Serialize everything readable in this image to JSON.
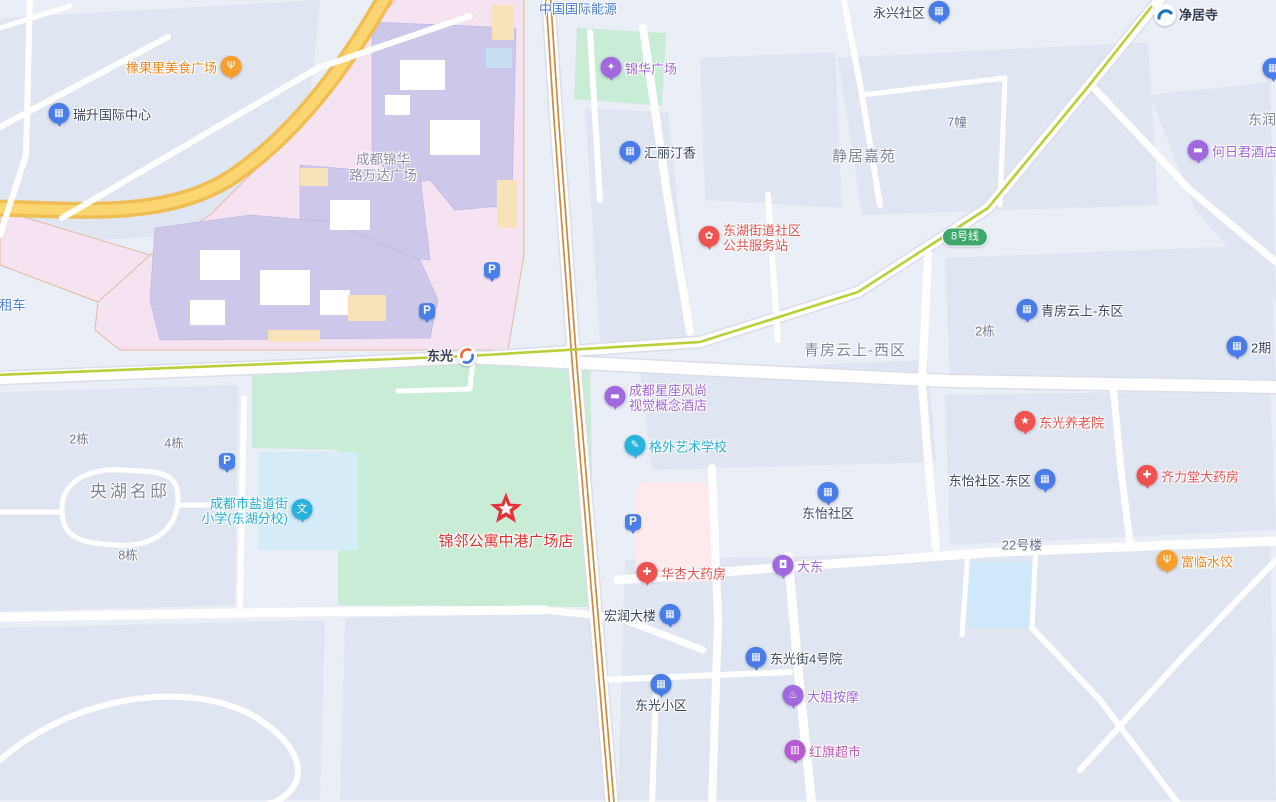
{
  "colors": {
    "bg": "#eaeef6",
    "block": "#e0e6f1",
    "road": "#ffffff",
    "road_casing": "#d9deea",
    "highway_outer": "#f0bd55",
    "highway_inner": "#fbd570",
    "mall_zone": "#f6e3f2",
    "mall_zone_border": "#e3b9a0",
    "mall_building": "#cdc7ea",
    "mall_tan": "#f8e2ba",
    "mall_blue": "#c6dff2",
    "park": "#c9ecd6",
    "school_ground": "#d5ebf8",
    "pool": "#cfe9fa",
    "hospital": "#fdeaec",
    "metro_line": "#b9cf3a",
    "rail_orange": "#cf8a3e",
    "line8_badge": "#3ea76a",
    "pin_blue": "#4a7ce8",
    "pin_purple": "#a268dd",
    "pin_red": "#ee5350",
    "pin_orange": "#f5a02d",
    "pin_cyan": "#29b2dc",
    "pin_magenta": "#b75ad2",
    "star_red": "#e53238",
    "text_dark": "#3a4660",
    "text_gray": "#7e8798",
    "text_gray_small": "#6e7890",
    "text_red": "#e8504d",
    "text_orange": "#f0871d",
    "text_purple": "#a266d8",
    "text_cyan": "#21b0d8",
    "text_blue": "#4a7dd4",
    "text_magenta": "#c45ab8",
    "text_wanda": "#8f8ba6",
    "text_star": "#e12f2f"
  },
  "map": {
    "pois": [
      {
        "id": "poi-xiangguoli-food-plaza",
        "type": "pin",
        "x": 231,
        "y": 68,
        "color": "#f5a02d",
        "glyph": "Ψ",
        "icon": "food-pin-icon",
        "label": {
          "text": "橡果里美食广场",
          "side": "left",
          "color": "#f0871d"
        }
      },
      {
        "id": "poi-ruisheng-intl-center",
        "type": "pin",
        "x": 59,
        "y": 115,
        "color": "#4a7ce8",
        "glyph": "▦",
        "icon": "building-pin-icon",
        "label": {
          "text": "瑞升国际中心",
          "side": "right",
          "color": "#3a4660"
        }
      },
      {
        "id": "label-china-intl-energy",
        "type": "text",
        "x": 578,
        "y": 9,
        "interactable": false,
        "label": {
          "text": "中国国际能源",
          "side": "center",
          "color": "#4a7dd4"
        }
      },
      {
        "id": "poi-jinhua-plaza",
        "type": "pin",
        "x": 611,
        "y": 69,
        "color": "#a268dd",
        "glyph": "✦",
        "icon": "plaza-pin-icon",
        "label": {
          "text": "锦华广场",
          "side": "right",
          "color": "#a266d8"
        }
      },
      {
        "id": "poi-yongxing-community",
        "type": "pin",
        "x": 939,
        "y": 13,
        "color": "#4a7ce8",
        "glyph": "▦",
        "icon": "building-pin-icon",
        "label": {
          "text": "永兴社区",
          "side": "left",
          "color": "#3a4660"
        }
      },
      {
        "id": "poi-jingjusi-metro-station",
        "type": "metro",
        "x": 1165,
        "y": 15,
        "icon": "metro-station-icon",
        "label": {
          "text": "净居寺",
          "side": "right",
          "color": "#333c52",
          "bold": true
        }
      },
      {
        "id": "poi-partial-pin-right-edge",
        "type": "pin",
        "x": 1273,
        "y": 70,
        "color": "#4a7ce8",
        "glyph": "▦",
        "icon": "building-pin-icon"
      },
      {
        "id": "label-dongrun",
        "type": "text",
        "x": 1262,
        "y": 120,
        "interactable": false,
        "label": {
          "text": "东润",
          "side": "center",
          "color": "#7e8798",
          "size": 14
        }
      },
      {
        "id": "poi-heriju-hotel",
        "type": "pin",
        "x": 1198,
        "y": 152,
        "color": "#a268dd",
        "glyph": "▬",
        "icon": "hotel-bed-pin-icon",
        "label": {
          "text": "何日君酒店",
          "side": "right",
          "color": "#a266d8"
        }
      },
      {
        "id": "poi-huili-tingxiang",
        "type": "pin",
        "x": 630,
        "y": 153,
        "color": "#4a7ce8",
        "glyph": "▦",
        "icon": "building-pin-icon",
        "label": {
          "text": "汇丽汀香",
          "side": "right",
          "color": "#3a4660"
        }
      },
      {
        "id": "label-jingju-jiayuan",
        "type": "text",
        "x": 864,
        "y": 157,
        "interactable": false,
        "label": {
          "text": "静居嘉苑",
          "side": "center",
          "color": "#7e8798",
          "size": 15,
          "ls": 1
        }
      },
      {
        "id": "label-7zhuang",
        "type": "text",
        "x": 957,
        "y": 123,
        "interactable": false,
        "label": {
          "text": "7幢",
          "side": "center",
          "color": "#6e7890",
          "size": 12.5
        }
      },
      {
        "id": "label-wanda-plaza",
        "type": "text",
        "x": 383,
        "y": 168,
        "interactable": false,
        "label": {
          "lines": [
            "成都锦华",
            "路万达广场"
          ],
          "side": "center",
          "color": "#8f8ba6",
          "size": 13.5
        }
      },
      {
        "id": "poi-donghu-street-community-service",
        "type": "pin",
        "x": 709,
        "y": 238,
        "color": "#ee5350",
        "glyph": "✿",
        "icon": "flower-pin-icon",
        "label": {
          "lines": [
            "东湖街道社区",
            "公共服务站"
          ],
          "side": "right",
          "color": "#e8504d"
        }
      },
      {
        "id": "badge-line8",
        "type": "badge",
        "x": 965,
        "y": 237,
        "label": {
          "text": "8号线"
        }
      },
      {
        "id": "poi-qingfang-yunshang-east",
        "type": "pin",
        "x": 1027,
        "y": 311,
        "color": "#4a7ce8",
        "glyph": "▦",
        "icon": "building-pin-icon",
        "label": {
          "text": "青房云上-东区",
          "side": "right",
          "color": "#3a4660"
        }
      },
      {
        "id": "label-2dong-right",
        "type": "text",
        "x": 985,
        "y": 332,
        "interactable": false,
        "label": {
          "text": "2栋",
          "side": "center",
          "color": "#6e7890",
          "size": 12.5
        }
      },
      {
        "id": "poi-2qi",
        "type": "pin",
        "x": 1237,
        "y": 348,
        "color": "#4a7ce8",
        "glyph": "▦",
        "icon": "building-pin-icon",
        "label": {
          "text": "2期",
          "side": "right",
          "color": "#3a4660"
        }
      },
      {
        "id": "label-qingfang-yunshang-west",
        "type": "text",
        "x": 855,
        "y": 351,
        "interactable": false,
        "label": {
          "text": "青房云上-西区",
          "side": "center",
          "color": "#7e8798",
          "size": 15,
          "ls": 1
        }
      },
      {
        "id": "poi-dongguang-station",
        "type": "loop",
        "x": 467,
        "y": 356,
        "icon": "dongguang-loop-station-icon",
        "label": {
          "text": "东光",
          "side": "left",
          "color": "#333c52",
          "bold": true
        }
      },
      {
        "id": "label-zuche",
        "type": "text",
        "x": 6,
        "y": 305,
        "interactable": false,
        "label": {
          "text": "宇租车",
          "side": "center",
          "color": "#4a7dd4"
        }
      },
      {
        "id": "poi-xingzuo-fashion-hotel",
        "type": "pin",
        "x": 615,
        "y": 398,
        "color": "#a268dd",
        "glyph": "▬",
        "icon": "hotel-bed-pin-icon",
        "label": {
          "lines": [
            "成都星座风尚",
            "视觉概念酒店"
          ],
          "side": "right",
          "color": "#a266d8"
        }
      },
      {
        "id": "poi-gewai-art-school",
        "type": "pin",
        "x": 635,
        "y": 447,
        "color": "#29b2dc",
        "glyph": "✎",
        "icon": "school-pencil-pin-icon",
        "label": {
          "text": "格外艺术学校",
          "side": "right",
          "color": "#21b0d8"
        }
      },
      {
        "id": "poi-dongguang-nursing-home",
        "type": "pin",
        "x": 1025,
        "y": 423,
        "color": "#ee5350",
        "glyph": "★",
        "icon": "star-pin-icon",
        "label": {
          "text": "东光养老院",
          "side": "right",
          "color": "#e8504d"
        }
      },
      {
        "id": "poi-qilitang-pharmacy",
        "type": "pin",
        "x": 1147,
        "y": 477,
        "color": "#ee5350",
        "glyph": "✚",
        "icon": "pharmacy-pin-icon",
        "label": {
          "text": "齐力堂大药房",
          "side": "right",
          "color": "#e8504d"
        }
      },
      {
        "id": "poi-dongyi-community-east",
        "type": "pin",
        "x": 1045,
        "y": 481,
        "color": "#4a7ce8",
        "glyph": "▦",
        "icon": "building-pin-icon",
        "label": {
          "text": "东怡社区-东区",
          "side": "left",
          "color": "#3a4660"
        }
      },
      {
        "id": "poi-dongyi-community",
        "type": "pin",
        "x": 828,
        "y": 494,
        "color": "#4a7ce8",
        "glyph": "▦",
        "icon": "building-pin-icon",
        "label": {
          "text": "东怡社区",
          "side": "below",
          "color": "#3a4660"
        }
      },
      {
        "id": "label-2dong-left",
        "type": "text",
        "x": 79,
        "y": 440,
        "interactable": false,
        "label": {
          "text": "2栋",
          "side": "center",
          "color": "#6e7890",
          "size": 12.5
        }
      },
      {
        "id": "label-4dong",
        "type": "text",
        "x": 174,
        "y": 444,
        "interactable": false,
        "label": {
          "text": "4栋",
          "side": "center",
          "color": "#6e7890",
          "size": 12.5
        }
      },
      {
        "id": "label-8dong",
        "type": "text",
        "x": 128,
        "y": 556,
        "interactable": false,
        "label": {
          "text": "8栋",
          "side": "center",
          "color": "#6e7890",
          "size": 12.5
        }
      },
      {
        "id": "label-yanghu-mingdi",
        "type": "text",
        "x": 130,
        "y": 492,
        "interactable": false,
        "label": {
          "text": "央湖名邸",
          "side": "center",
          "color": "#7e8798",
          "size": 17,
          "ls": 3
        }
      },
      {
        "id": "poi-yandaojie-primary-school",
        "type": "pin",
        "x": 302,
        "y": 511,
        "color": "#29b2dc",
        "glyph": "文",
        "icon": "school-wen-pin-icon",
        "label": {
          "lines": [
            "成都市盐道街",
            "小学(东湖分校)"
          ],
          "side": "left",
          "color": "#21b0d8"
        }
      },
      {
        "id": "poi-jinlin-apartment-star",
        "type": "star",
        "x": 506,
        "y": 513,
        "icon": "red-star-marker-icon",
        "label": {
          "text": "锦邻公寓中港广场店",
          "side": "below",
          "color": "#e12f2f",
          "size": 15,
          "below_off": 20
        }
      },
      {
        "id": "label-22haolou",
        "type": "text",
        "x": 1022,
        "y": 545,
        "interactable": false,
        "label": {
          "text": "22号楼",
          "side": "center",
          "color": "#66708a",
          "size": 13
        }
      },
      {
        "id": "poi-fulin-dumplings",
        "type": "pin",
        "x": 1167,
        "y": 562,
        "color": "#f5a02d",
        "glyph": "Ψ",
        "icon": "food-pin-icon",
        "label": {
          "text": "富临水饺",
          "side": "right",
          "color": "#f0871d"
        }
      },
      {
        "id": "poi-dadong",
        "type": "pin",
        "x": 783,
        "y": 567,
        "color": "#a268dd",
        "glyph": "◘",
        "icon": "shopping-bag-pin-icon",
        "label": {
          "text": "大东",
          "side": "right",
          "color": "#a266d8"
        }
      },
      {
        "id": "poi-huaxing-pharmacy",
        "type": "pin",
        "x": 647,
        "y": 574,
        "color": "#ee5350",
        "glyph": "✚",
        "icon": "pharmacy-pin-icon",
        "label": {
          "text": "华杏大药房",
          "side": "right",
          "color": "#e8504d"
        }
      },
      {
        "id": "poi-hongrun-building",
        "type": "pin",
        "x": 670,
        "y": 616,
        "color": "#4a7ce8",
        "glyph": "▦",
        "icon": "building-pin-icon",
        "label": {
          "text": "宏润大楼",
          "side": "left",
          "color": "#3a4660"
        }
      },
      {
        "id": "poi-dongguangjie-4th-yard",
        "type": "pin",
        "x": 756,
        "y": 659,
        "color": "#4a7ce8",
        "glyph": "▦",
        "icon": "building-pin-icon",
        "label": {
          "text": "东光街4号院",
          "side": "right",
          "color": "#3a4660"
        }
      },
      {
        "id": "poi-dongguang-xiaoqu",
        "type": "pin",
        "x": 661,
        "y": 686,
        "color": "#4a7ce8",
        "glyph": "▦",
        "icon": "building-pin-icon",
        "label": {
          "text": "东光小区",
          "side": "below",
          "color": "#3a4660"
        }
      },
      {
        "id": "poi-dajie-massage",
        "type": "pin",
        "x": 793,
        "y": 697,
        "color": "#a268dd",
        "glyph": "♨",
        "icon": "massage-pin-icon",
        "label": {
          "text": "大姐按摩",
          "side": "right",
          "color": "#a266d8"
        }
      },
      {
        "id": "poi-hongqi-supermarket",
        "type": "pin",
        "x": 795,
        "y": 752,
        "color": "#b75ad2",
        "glyph": "▥",
        "icon": "shopping-cart-pin-icon",
        "label": {
          "text": "红旗超市",
          "side": "right",
          "color": "#c45ab8"
        }
      },
      {
        "id": "parking-wanda-east",
        "type": "parking",
        "x": 492,
        "y": 272,
        "icon": "parking-icon",
        "label_text": "P"
      },
      {
        "id": "parking-wanda-south",
        "type": "parking",
        "x": 427,
        "y": 313,
        "icon": "parking-icon",
        "label_text": "P"
      },
      {
        "id": "parking-yanghu",
        "type": "parking",
        "x": 227,
        "y": 463,
        "icon": "parking-icon",
        "label_text": "P"
      },
      {
        "id": "parking-hospital",
        "type": "parking",
        "x": 633,
        "y": 524,
        "icon": "parking-icon",
        "label_text": "P"
      }
    ]
  }
}
